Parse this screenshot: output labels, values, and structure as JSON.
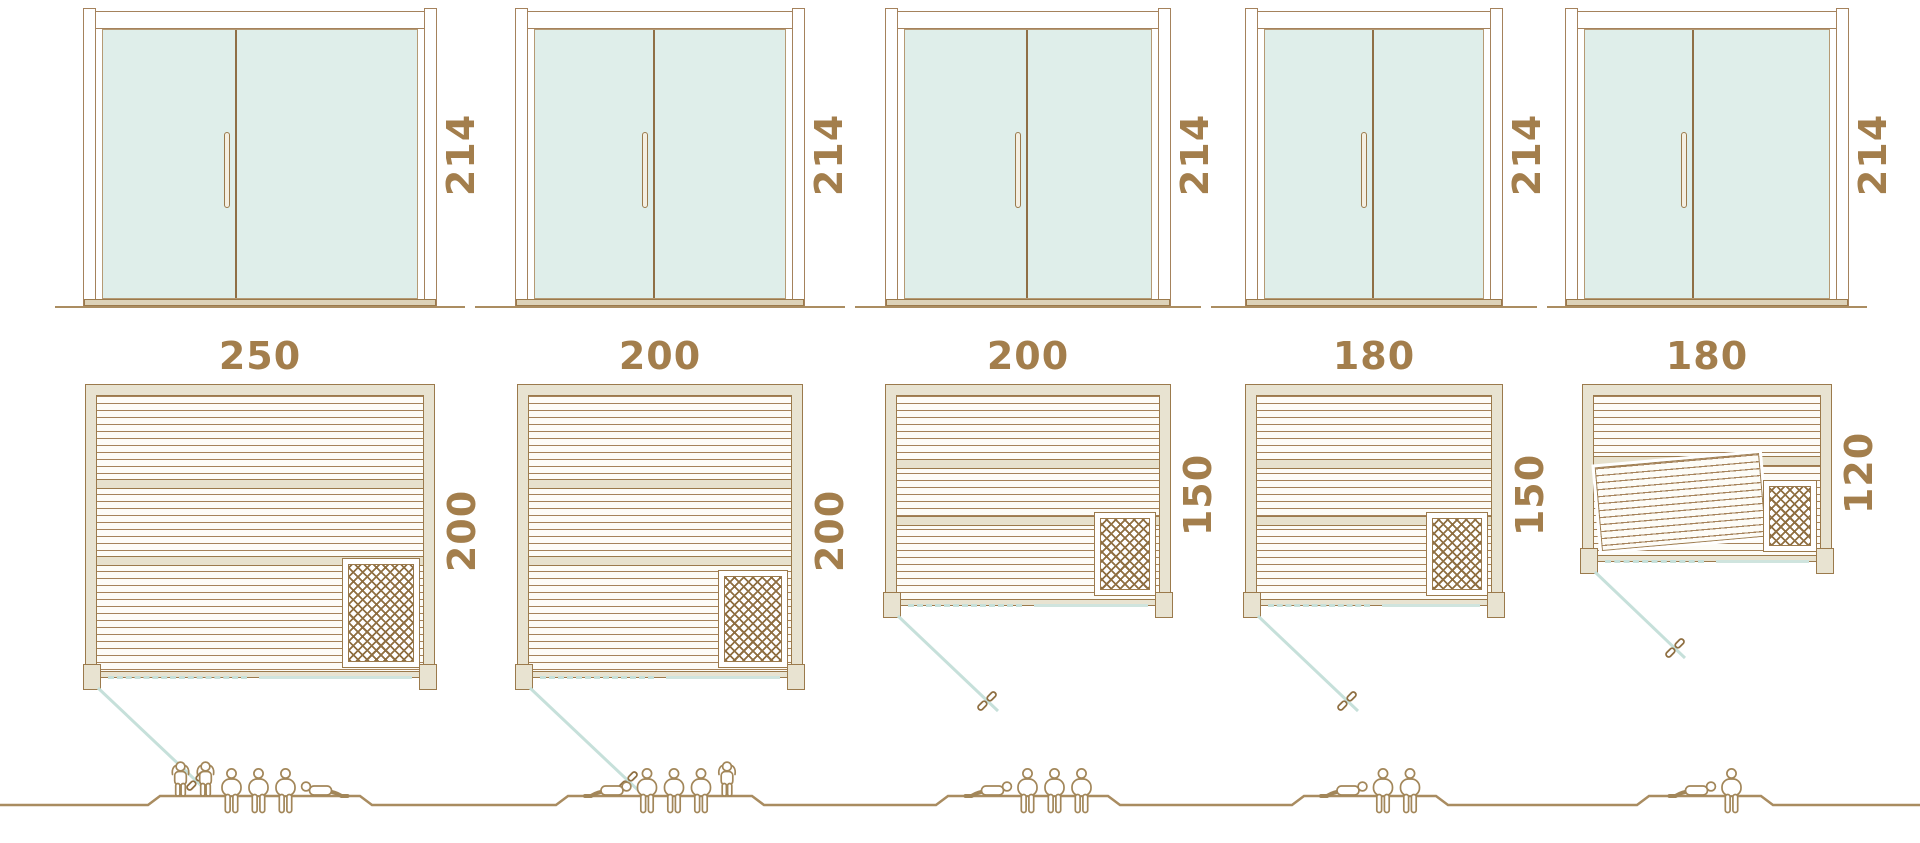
{
  "colors": {
    "line_brown": "#9b7a4c",
    "label_brown": "#a37e4c",
    "wall_beige": "#e8e3d1",
    "glass_fill": "#dfeeea",
    "glass_line_teal": "#c6e0da",
    "ground_brown": "#ab8d61"
  },
  "units": [
    {
      "name": "sauna-250x200",
      "door_height_cm": "214",
      "width_cm": "250",
      "depth_cm": "200",
      "capacity": 6,
      "people": [
        "standing",
        "standing",
        "sitting",
        "sitting",
        "sitting",
        "lying"
      ],
      "has_heater": true,
      "has_tilted_bench": false
    },
    {
      "name": "sauna-200x200",
      "door_height_cm": "214",
      "width_cm": "200",
      "depth_cm": "200",
      "capacity": 5,
      "people": [
        "lying",
        "sitting",
        "sitting",
        "sitting",
        "standing"
      ],
      "has_heater": true,
      "has_tilted_bench": false
    },
    {
      "name": "sauna-200x150",
      "door_height_cm": "214",
      "width_cm": "200",
      "depth_cm": "150",
      "capacity": 4,
      "people": [
        "lying",
        "sitting",
        "sitting",
        "sitting"
      ],
      "has_heater": true,
      "has_tilted_bench": false
    },
    {
      "name": "sauna-180x150",
      "door_height_cm": "214",
      "width_cm": "180",
      "depth_cm": "150",
      "capacity": 3,
      "people": [
        "lying",
        "sitting",
        "sitting"
      ],
      "has_heater": true,
      "has_tilted_bench": false
    },
    {
      "name": "sauna-180x120",
      "door_height_cm": "214",
      "width_cm": "180",
      "depth_cm": "120",
      "capacity": 2,
      "people": [
        "lying",
        "sitting"
      ],
      "has_heater": true,
      "has_tilted_bench": true
    }
  ]
}
